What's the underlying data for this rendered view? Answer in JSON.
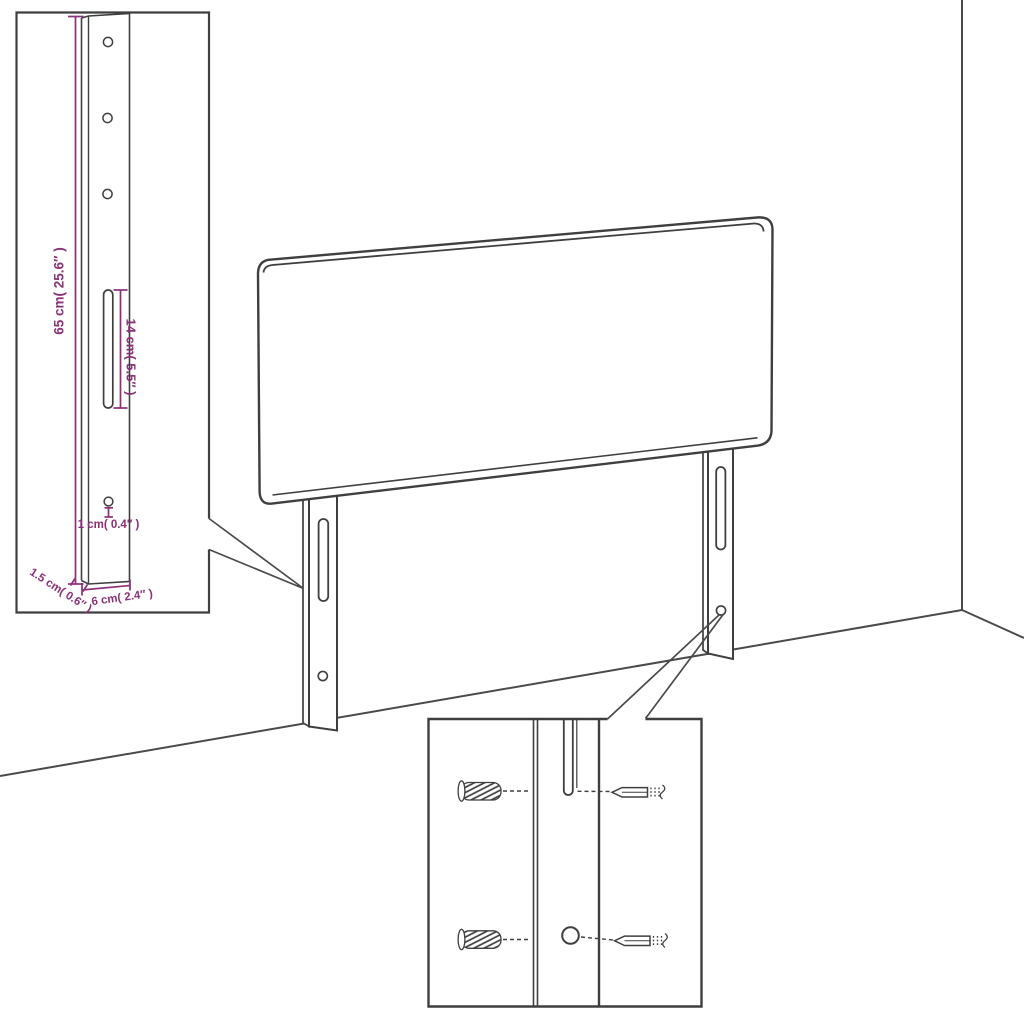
{
  "diagram": {
    "kind": "furniture-assembly-diagram",
    "subject": "headboard-with-mounting-legs",
    "colors": {
      "background": "#ffffff",
      "line": "#3f3f3f",
      "accent": "#8b2f76"
    },
    "labels": {
      "leg_height": "65 cm( 25.6″ )",
      "slot_length": "14 cm( 5.5″ )",
      "hole_size": "1 cm( 0.4″ )",
      "leg_thickness": "1.5 cm( 0.6″ )",
      "leg_width": "6 cm( 2.4″ )"
    },
    "glyphs": {
      "wall_plug": "ribbed-anchor-icon",
      "screw": "screw-icon"
    }
  }
}
